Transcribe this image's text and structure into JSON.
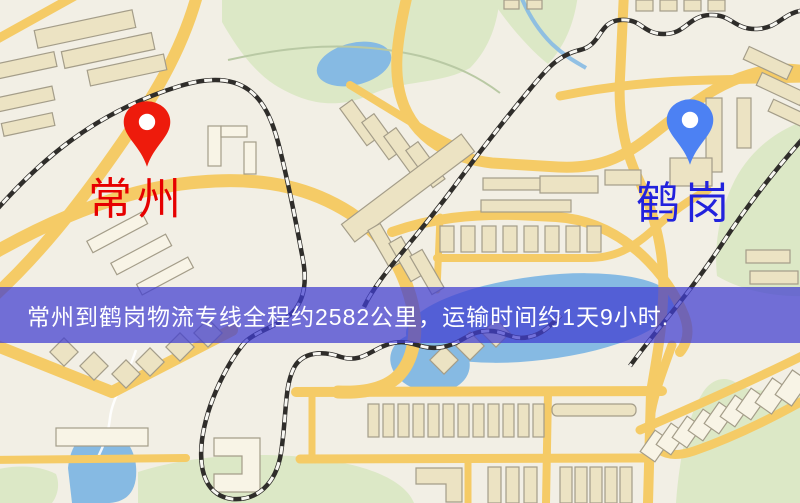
{
  "banner": {
    "text": "常州到鹤岗物流专线全程约2582公里，运输时间约1天9小时."
  },
  "markers": {
    "origin": {
      "name": "常州"
    },
    "destination": {
      "name": "鹤岗"
    }
  },
  "colors": {
    "land": "#f2efe5",
    "park": "#dce8c6",
    "water": "#86bae3",
    "road": "#f5cb66",
    "building": "#ece3c3",
    "building_light": "#f8f4e6",
    "building_stroke": "#a49d89",
    "rail": "#2f2d2a",
    "rail_dash": "#f8f7f2",
    "trail": "#b9c9a4",
    "stream": "#ffffff",
    "banner_bg": "rgba(64,62,208,0.73)",
    "banner_text": "#ffffff",
    "origin_pin": "#ee1b0c",
    "origin_label": "#e60000",
    "dest_pin": "#4c81f3",
    "dest_label": "#2222dd"
  }
}
